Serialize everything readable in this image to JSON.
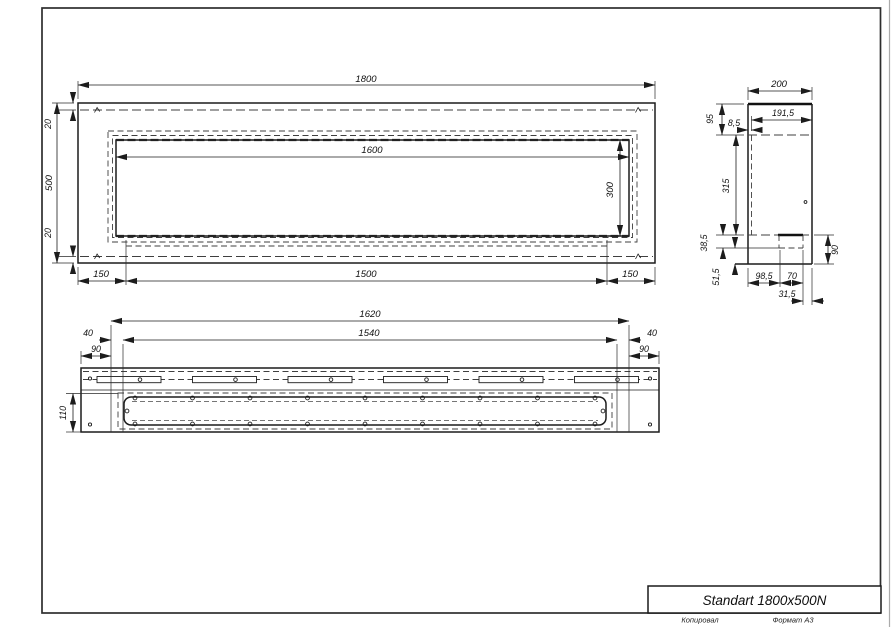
{
  "sheet": {
    "title": "Standart 1800x500N",
    "footer": {
      "copied": "Копировал",
      "format": "Формат A3"
    }
  },
  "front_view": {
    "dim_width": "1800",
    "dim_height": "500",
    "dim_top_offset": "20",
    "dim_bottom_offset": "20",
    "dim_opening_width": "1600",
    "dim_opening_height": "300",
    "dim_left_margin": "150",
    "dim_center_span": "1500",
    "dim_right_margin": "150"
  },
  "side_view": {
    "dim_depth": "200",
    "dim_inner_depth": "191,5",
    "dim_top_section": "95",
    "dim_front_gap": "8,5",
    "dim_body_height": "315",
    "dim_step_upper": "38,5",
    "dim_step_lower": "51,5",
    "dim_bottom_a": "98,5",
    "dim_bottom_b": "70",
    "dim_bottom_c": "31,5",
    "dim_bottom_height": "90"
  },
  "top_view": {
    "dim_span": "1620",
    "dim_inner_span": "1540",
    "dim_offset_left": "40",
    "dim_offset_right": "40",
    "dim_inset_left": "90",
    "dim_inset_right": "90",
    "dim_depth": "110"
  }
}
